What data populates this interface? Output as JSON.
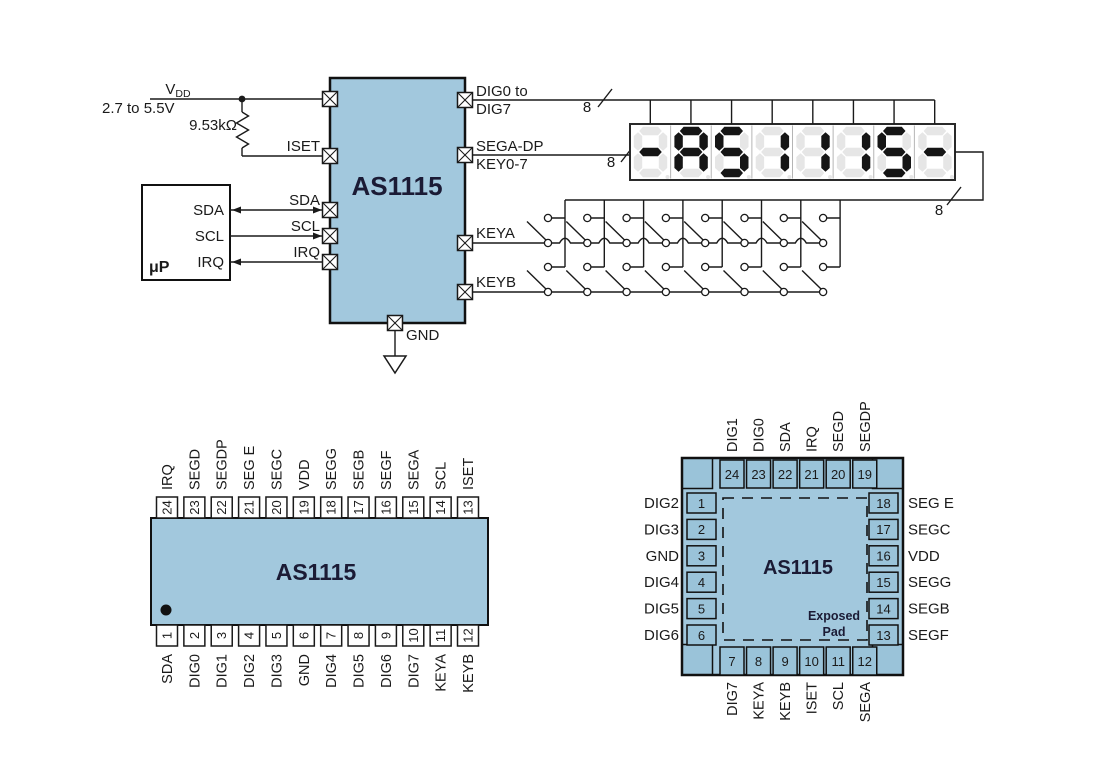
{
  "colors": {
    "chip_fill": "#A2C8DD",
    "pad_fill": "#9AC3D9",
    "chip_text": "#1B1B35",
    "wire": "#1A1A1A",
    "seg_on": "#151515",
    "seg_off": "#E6E6E6"
  },
  "schematic": {
    "chip_label": "AS1115",
    "power": {
      "v": "V",
      "dd": "DD",
      "range": "2.7 to 5.5V",
      "resistor": "9.53kΩ"
    },
    "mcu": {
      "label": "μP",
      "sda": "SDA",
      "scl": "SCL",
      "irq": "IRQ"
    },
    "pin_labels": {
      "iset": "ISET",
      "sda": "SDA",
      "scl": "SCL",
      "irq": "IRQ",
      "gnd": "GND",
      "keya": "KEYA",
      "keyb": "KEYB",
      "dig1": "DIG0 to",
      "dig2": "DIG7",
      "seg1": "SEGA-DP",
      "seg2": "KEY0-7"
    },
    "bus_width": "8",
    "display": {
      "value": "-AS1115-",
      "digits": 8
    }
  },
  "soic": {
    "chip_label": "AS1115",
    "top_pins": [
      {
        "num": "24",
        "name": "IRQ"
      },
      {
        "num": "23",
        "name": "SEGD"
      },
      {
        "num": "22",
        "name": "SEGDP"
      },
      {
        "num": "21",
        "name": "SEG E"
      },
      {
        "num": "20",
        "name": "SEGC"
      },
      {
        "num": "19",
        "name": "VDD"
      },
      {
        "num": "18",
        "name": "SEGG"
      },
      {
        "num": "17",
        "name": "SEGB"
      },
      {
        "num": "16",
        "name": "SEGF"
      },
      {
        "num": "15",
        "name": "SEGA"
      },
      {
        "num": "14",
        "name": "SCL"
      },
      {
        "num": "13",
        "name": "ISET"
      }
    ],
    "bottom_pins": [
      {
        "num": "1",
        "name": "SDA"
      },
      {
        "num": "2",
        "name": "DIG0"
      },
      {
        "num": "3",
        "name": "DIG1"
      },
      {
        "num": "4",
        "name": "DIG2"
      },
      {
        "num": "5",
        "name": "DIG3"
      },
      {
        "num": "6",
        "name": "GND"
      },
      {
        "num": "7",
        "name": "DIG4"
      },
      {
        "num": "8",
        "name": "DIG5"
      },
      {
        "num": "9",
        "name": "DIG6"
      },
      {
        "num": "10",
        "name": "DIG7"
      },
      {
        "num": "11",
        "name": "KEYA"
      },
      {
        "num": "12",
        "name": "KEYB"
      }
    ]
  },
  "qfn": {
    "chip_label": "AS1115",
    "exposed_line1": "Exposed",
    "exposed_line2": "Pad",
    "top_pins": [
      {
        "num": "24",
        "name": "DIG1"
      },
      {
        "num": "23",
        "name": "DIG0"
      },
      {
        "num": "22",
        "name": "SDA"
      },
      {
        "num": "21",
        "name": "IRQ"
      },
      {
        "num": "20",
        "name": "SEGD"
      },
      {
        "num": "19",
        "name": "SEGDP"
      }
    ],
    "left_pins": [
      {
        "num": "1",
        "name": "DIG2"
      },
      {
        "num": "2",
        "name": "DIG3"
      },
      {
        "num": "3",
        "name": "GND"
      },
      {
        "num": "4",
        "name": "DIG4"
      },
      {
        "num": "5",
        "name": "DIG5"
      },
      {
        "num": "6",
        "name": "DIG6"
      }
    ],
    "right_pins": [
      {
        "num": "18",
        "name": "SEG E"
      },
      {
        "num": "17",
        "name": "SEGC"
      },
      {
        "num": "16",
        "name": "VDD"
      },
      {
        "num": "15",
        "name": "SEGG"
      },
      {
        "num": "14",
        "name": "SEGB"
      },
      {
        "num": "13",
        "name": "SEGF"
      }
    ],
    "bottom_pins": [
      {
        "num": "7",
        "name": "DIG7"
      },
      {
        "num": "8",
        "name": "KEYA"
      },
      {
        "num": "9",
        "name": "KEYB"
      },
      {
        "num": "10",
        "name": "ISET"
      },
      {
        "num": "11",
        "name": "SCL"
      },
      {
        "num": "12",
        "name": "SEGA"
      }
    ]
  }
}
